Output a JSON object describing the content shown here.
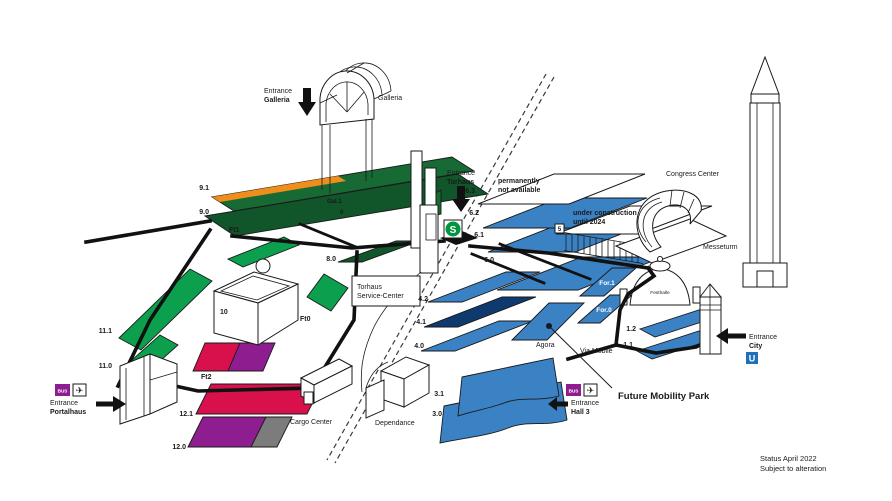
{
  "colors": {
    "hall_blue": "#3b82c4",
    "hall_blue_dark": "#0e3a6d",
    "green_dark": "#186a34",
    "green_deep": "#11552a",
    "green_bright": "#0ca04e",
    "orange": "#ef8d1d",
    "red": "#d8104b",
    "purple": "#8e1e8f",
    "gray": "#7c7c7c",
    "sbahn_green": "#009640",
    "ubahn_blue": "#1d71b8",
    "bus_purple": "#8e1e8f",
    "note_color": "#2e4257"
  },
  "halls": {
    "h9_1": "9.1",
    "h9_0": "9.0",
    "h11_1": "11.1",
    "h11_0": "11.0",
    "h12_1": "12.1",
    "h12_0": "12.0",
    "ft1": "Ft1",
    "ft2": "Ft2",
    "ft0": "Ft0",
    "h10": "10",
    "h8_0": "8.0",
    "h6_3": "6.3",
    "h6_2": "6.2",
    "h6_1": "6.1",
    "h6_0": "6.0",
    "h5": "5",
    "h4_2": "4.2",
    "h4_1": "4.1",
    "h4_0": "4.0",
    "h3_1": "3.1",
    "h3_0": "3.0",
    "h1_2": "1.2",
    "h1_1": "1.1",
    "for1": "For.1",
    "for0": "For.0",
    "gal1": "Gal.1",
    "gal0": "0"
  },
  "entrances": {
    "galleria": {
      "l1": "Entrance",
      "l2": "Galleria"
    },
    "torhaus": {
      "l1": "Entrance",
      "l2": "Torhaus"
    },
    "portalhaus": {
      "l1": "Entrance",
      "l2": "Portalhaus"
    },
    "city": {
      "l1": "Entrance",
      "l2": "City"
    },
    "hall3": {
      "l1": "Entrance",
      "l2": "Hall 3"
    }
  },
  "places": {
    "galleria": "Galleria",
    "congress_center": "Congress Center",
    "messeturm": "Messeturm",
    "festhalle": "Festhalle",
    "torhaus_service_l1": "Torhaus",
    "torhaus_service_l2": "Service-Center",
    "cargo_center": "Cargo Center",
    "dependance": "Dependance",
    "agora": "Agora",
    "via_mobile": "Via Mobile",
    "future_mobility_park": "Future Mobility Park"
  },
  "notes": {
    "permanently_l1": "permanently",
    "permanently_l2": "not available",
    "construction_l1": "under construction",
    "construction_l2": "until 2024",
    "status_l1": "Status April 2022",
    "status_l2": "Subject to alteration"
  },
  "icons": {
    "bus": "BUS",
    "sbahn": "S",
    "ubahn": "U",
    "plane": "✈"
  }
}
